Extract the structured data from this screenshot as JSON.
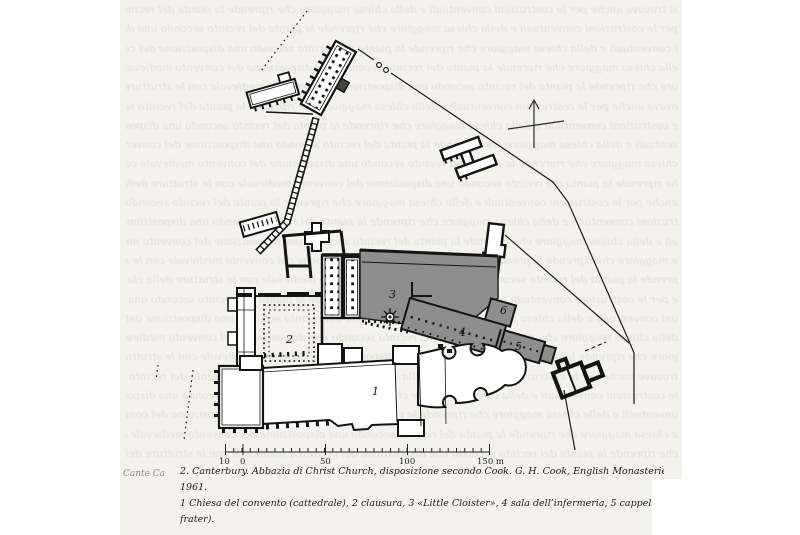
{
  "page": {
    "background": "#ffffff",
    "scan_background": "#f3f2ee",
    "ink_color": "#141414",
    "shade_gray": "#8e8e8e"
  },
  "bleed": {
    "filler": "si trovava anche per le costruzioni conventuali e della chiesa maggiore che riprende la pianta del recinto secondo una disposizione del convento medievale con le strutture della clausura e i chiostri minori verso il lato dei monaci ",
    "line_count": 24,
    "line_step": 19.3
  },
  "caption": {
    "sidenote": "Cante Ca",
    "line1": "2. Canterbury. Abbazia di Christ Church, disposizione secondo Cook. G. H. Cook, English Monasteries in the Middle Ages, Lon",
    "line2": "1961.",
    "line3": "1 Chiesa del convento (cattedrale), 2 clausura, 3 «Little Cloister», 4 sala dell’infermeria, 5 cappella dell’infermeria, 6 misericord (",
    "line4": "frater)."
  },
  "plan": {
    "labels": [
      {
        "text": "2",
        "x": 286,
        "y": 343
      },
      {
        "text": "3",
        "x": 389,
        "y": 298
      },
      {
        "text": "4",
        "x": 459,
        "y": 336
      },
      {
        "text": "5",
        "x": 515,
        "y": 350
      },
      {
        "text": "6",
        "x": 500,
        "y": 314
      },
      {
        "text": "1",
        "x": 372,
        "y": 395
      }
    ],
    "scale": {
      "x_start": 225.5,
      "x_end": 489.5,
      "minor_step": 8.25,
      "majors": [
        225.5,
        243,
        325.5,
        407.5,
        489.5
      ],
      "baseline_y": 452,
      "labels": [
        {
          "text": "10",
          "x": 219
        },
        {
          "text": "0",
          "x": 240
        },
        {
          "text": "50",
          "x": 320
        },
        {
          "text": "100",
          "x": 399
        },
        {
          "text": "150 m",
          "x": 477
        }
      ],
      "label_y": 464
    }
  }
}
